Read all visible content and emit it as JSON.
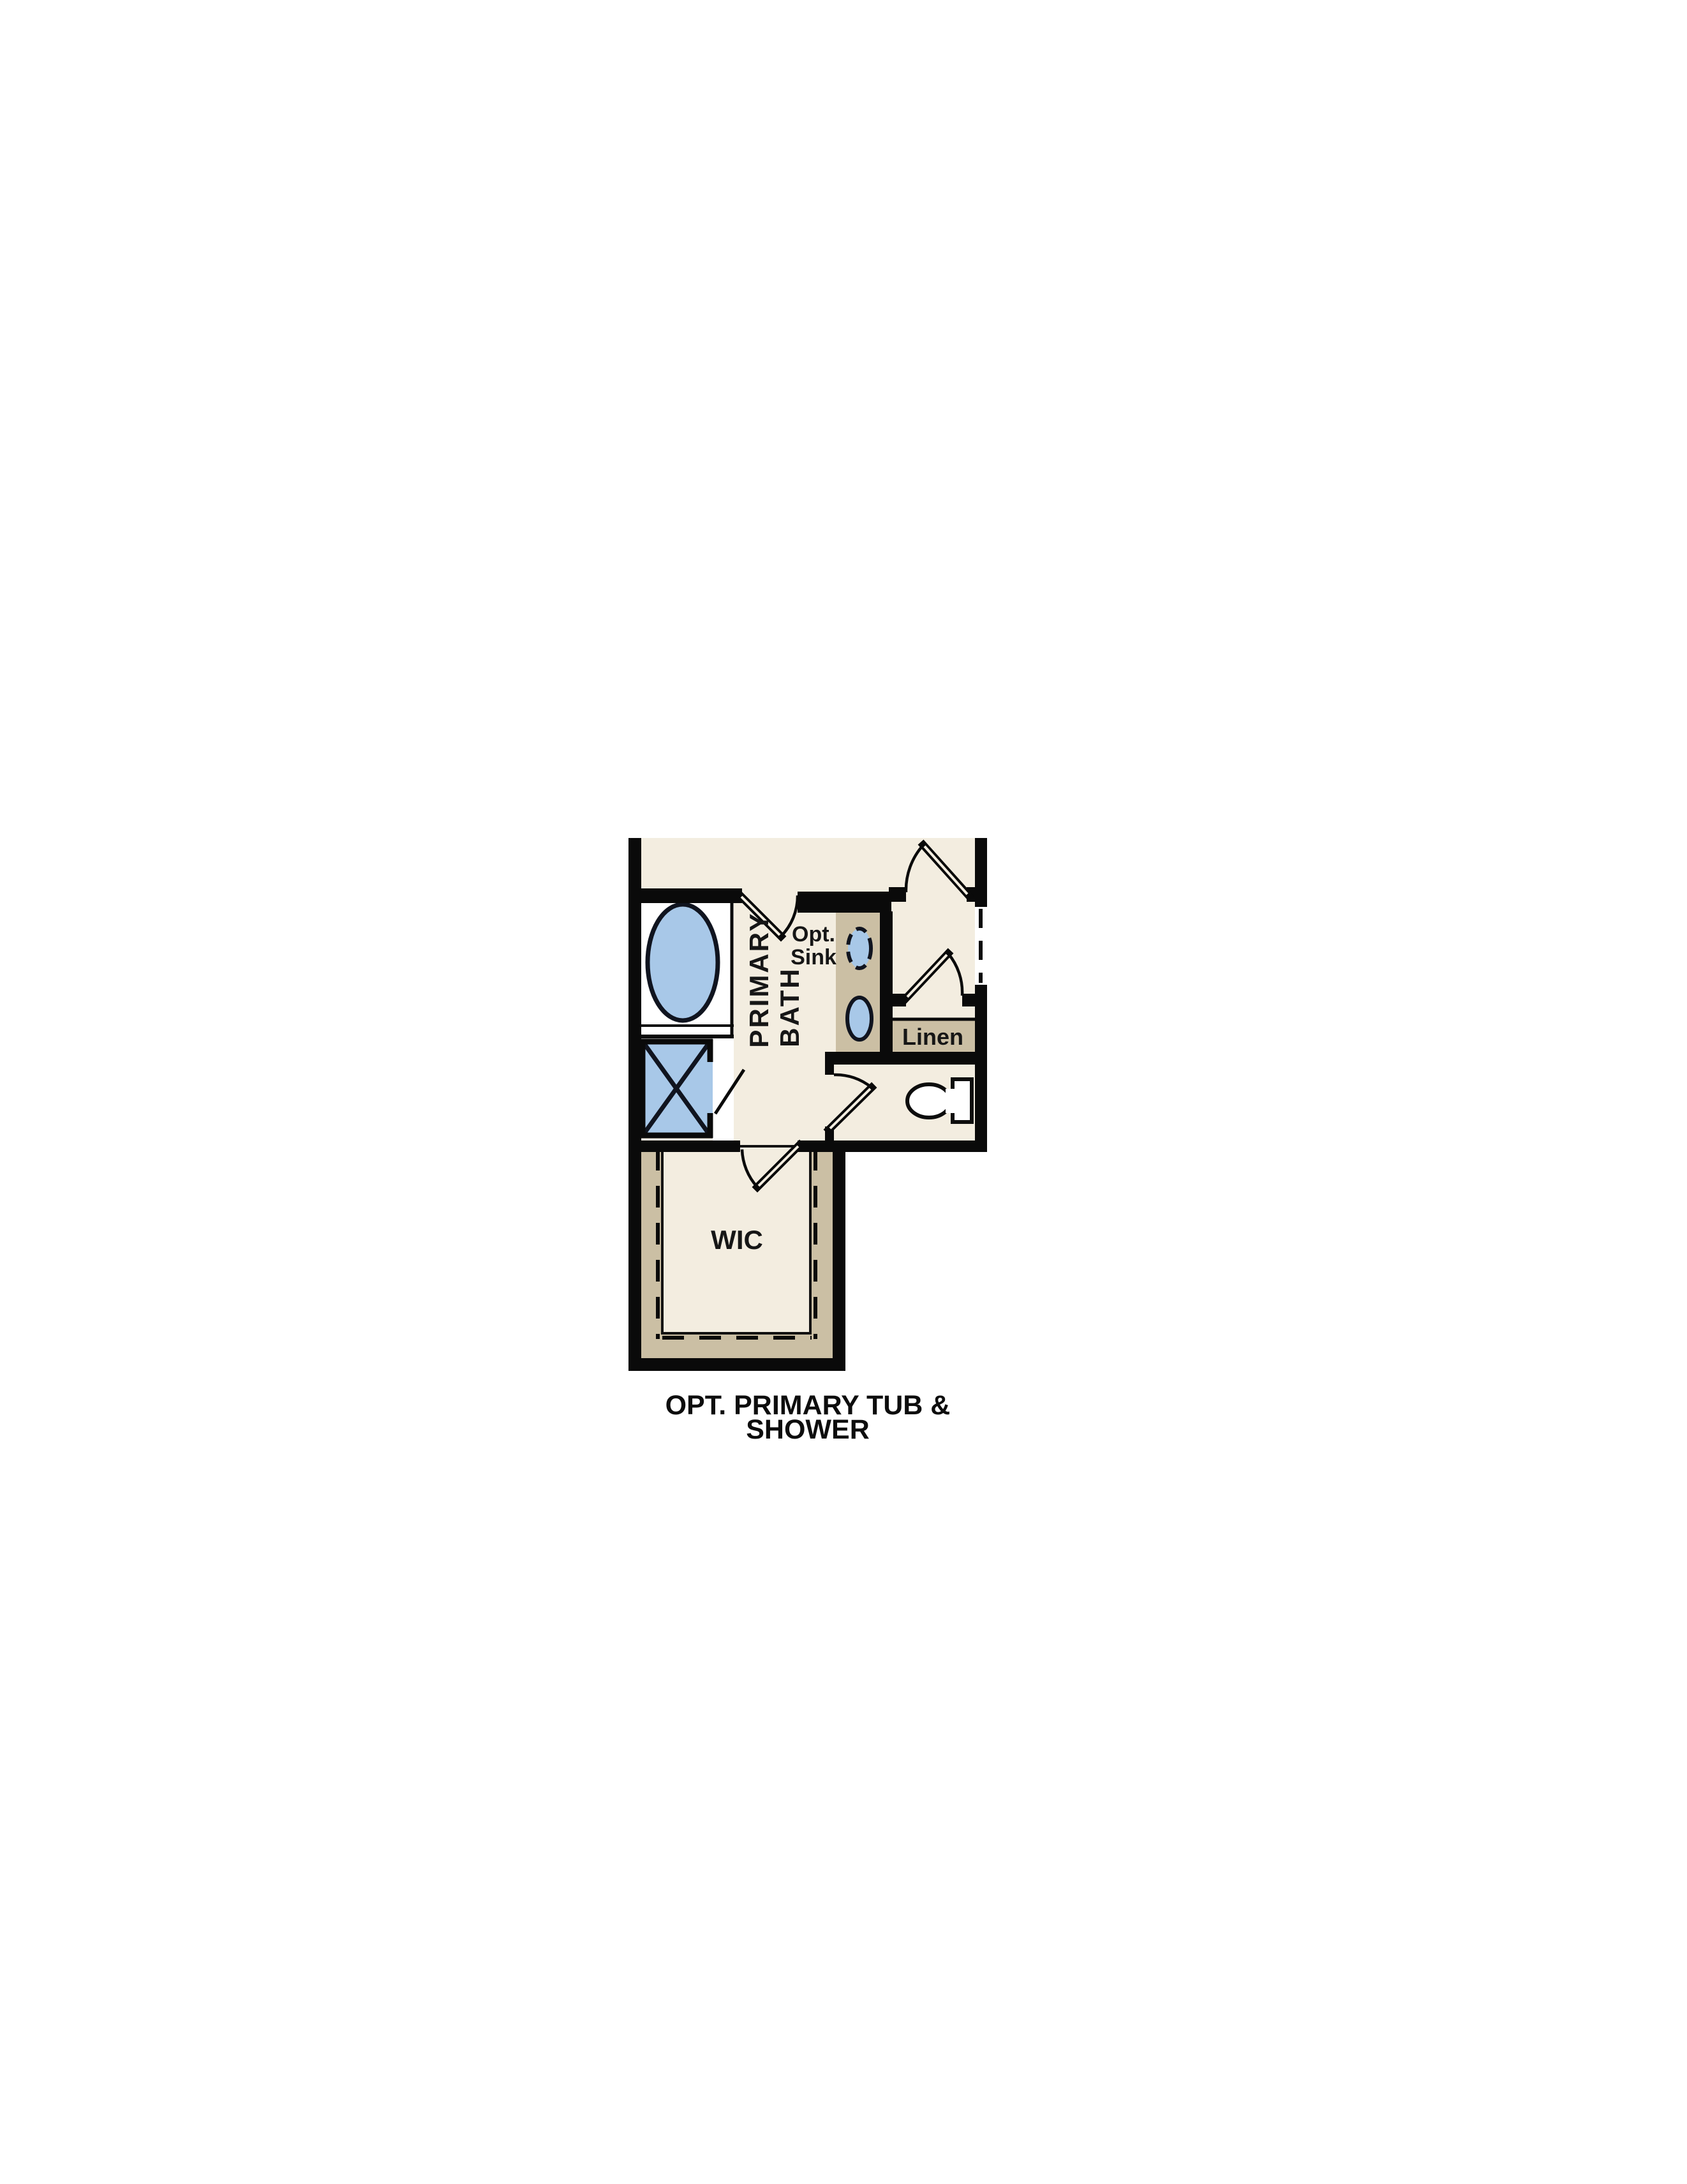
{
  "title": {
    "line1": "OPT. PRIMARY TUB &",
    "line2": "SHOWER"
  },
  "rooms": {
    "primary_bath": {
      "label_line1": "PRIMARY",
      "label_line2": "BATH"
    },
    "wic": {
      "label": "WIC"
    },
    "linen": {
      "label": "Linen"
    },
    "optional_sink": {
      "label_line1": "Opt.",
      "label_line2": "Sink"
    }
  },
  "fixtures": [
    "tub",
    "shower",
    "vanity-with-two-sinks",
    "optional-sink",
    "toilet",
    "linen-shelving",
    "wic-shelving"
  ],
  "colors": {
    "background": "#ffffff",
    "floor": "#f3ede0",
    "casework_tan": "#cbbfa4",
    "fixture_blue": "#a8c8e8",
    "wall_black": "#0a0a0a",
    "fixture_outline": "#10141f",
    "label_text": "#161616"
  }
}
